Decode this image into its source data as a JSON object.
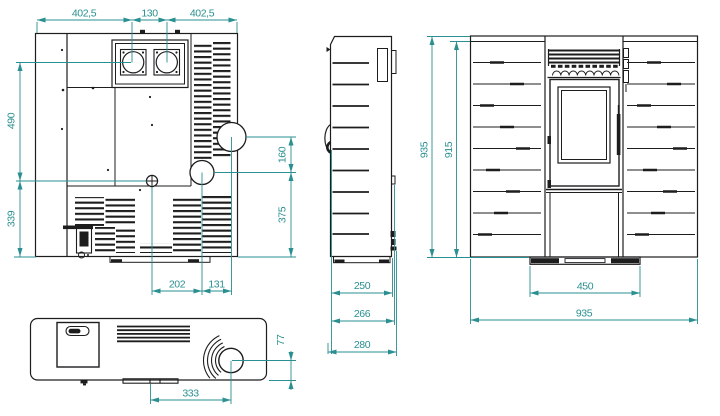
{
  "colors": {
    "accent": "#2a8f90",
    "ink": "#1d1d1e"
  },
  "views": {
    "rear": {
      "dims": {
        "top_left": "402,5",
        "top_center": "130",
        "top_right": "402,5",
        "left_upper": "490",
        "left_lower": "339",
        "right_upper": "160",
        "right_lower": "375",
        "bottom_inner": "202",
        "bottom_outer": "131"
      }
    },
    "side": {
      "dims": {
        "body_depth": "250",
        "mid_depth": "266",
        "total_depth": "280"
      }
    },
    "front": {
      "dims": {
        "total_height": "935",
        "side_height": "915",
        "base_width": "450",
        "total_width": "935"
      }
    },
    "top": {
      "dims": {
        "flue_offset_x": "333",
        "flue_offset_y": "77"
      }
    }
  }
}
